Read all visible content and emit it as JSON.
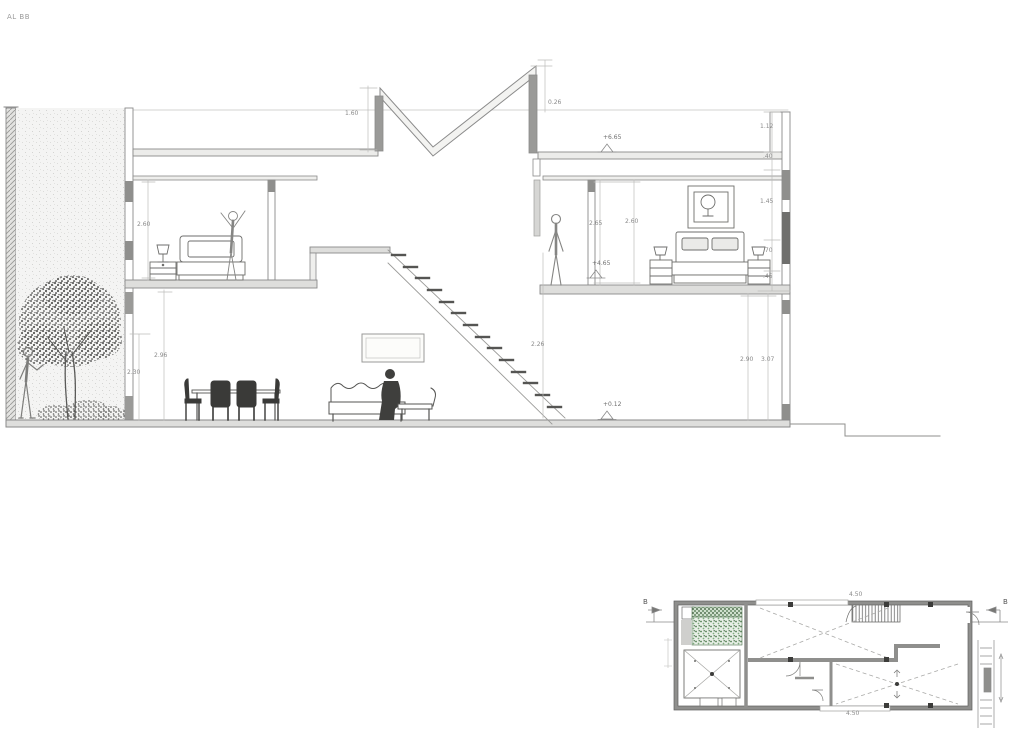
{
  "title": "AL BB",
  "colors": {
    "line": "#8a8a8a",
    "dark": "#3c3c3c",
    "foliage_green": "#5d8f5d",
    "wall_gray": "#9a9a9a"
  },
  "section": {
    "dims": {
      "roof_left": "1.60",
      "roof_right": "0.26",
      "level_roof": "+6.65",
      "level_bedroom": "+4.65",
      "level_ground": "+0.12",
      "right_col_a": "1.12",
      "right_col_b": ".40",
      "right_col_c": "1.45",
      "right_col_d": ".70",
      "right_col_e": ".45",
      "bedroom_left_h": "2.60",
      "bedroom_right_h1": "2.65",
      "bedroom_right_h2": "2.60",
      "ground_left_h1": "2.96",
      "ground_left_h2": "2.30",
      "stair_h": "2.26",
      "ground_right_h1": "2.90",
      "ground_right_h2": "3.07"
    }
  },
  "plan": {
    "section_marker_left": "B",
    "section_marker_right": "B",
    "dim_top": "4.50",
    "dim_bottom": "4.50"
  }
}
